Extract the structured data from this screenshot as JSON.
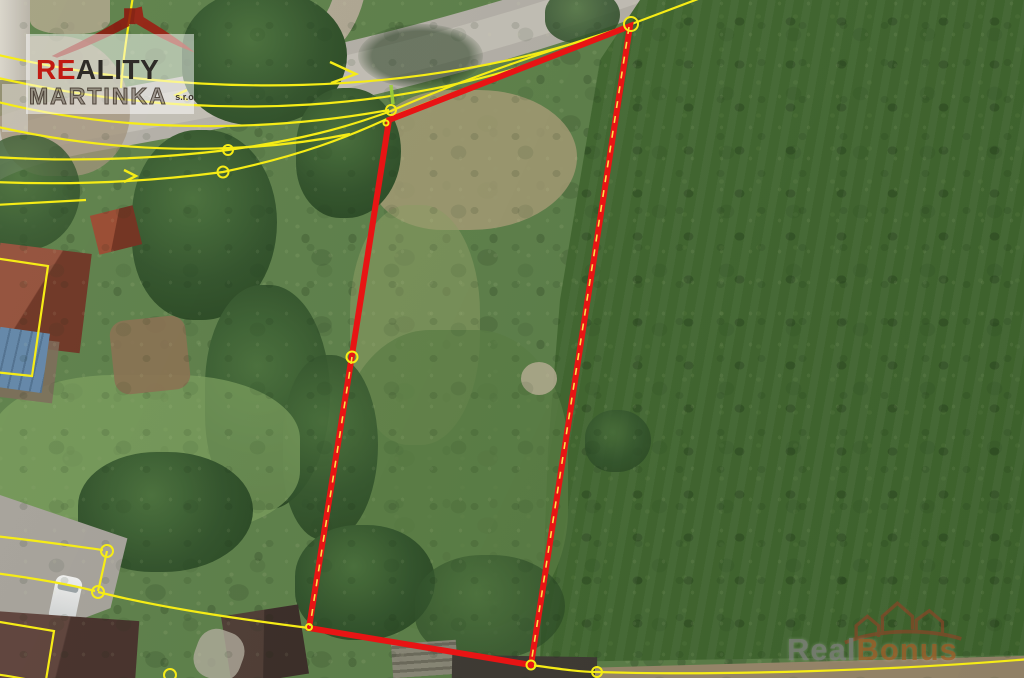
{
  "branding": {
    "agency_logo": {
      "icon": "roof-swoosh-icon",
      "word_accent": "RE",
      "word_rest": "ALITY",
      "word_secondary": "MARTINKA",
      "word_suffix": "s.r.o.",
      "accent_color": "#c11a12",
      "text_color": "#2e2b27"
    },
    "portal_watermark": {
      "icon": "houses-swoosh-icon",
      "word_part1": "Real",
      "word_part2": "Bonus",
      "part1_color": "#8d8d8a",
      "part2_color": "#a5612a"
    }
  },
  "map": {
    "kind": "aerial-photo-with-cadastral-overlay",
    "highlight_color": "#e81414",
    "cadastral_color": "#f6ec16",
    "parcel_points": "389,120 630,26 531,665 309,628",
    "edge_dashes": [
      "M 629,27 L 531,664",
      "M 352,357 L 310,626"
    ],
    "survey_tick": "M 391,85 L 393,104",
    "road_path": "M 655,-20 C 430,62 240,96 95,122 C 45,131 5,142 -20,158",
    "road_spur": "M 350,-8 C 345,15 335,30 322,42",
    "lines": [
      "M -6,54 C 180,98 420,102 629,25 L 706,-4",
      "M -6,77 C 200,124 420,120 628,27",
      "M -6,101 C 140,138 290,128 389,110",
      "M -6,126 C 150,162 280,148 350,134",
      "M -6,157 C 90,163 170,157 228,150 C 300,140 345,128 391,111 C 470,76 560,47 628,26",
      "M -6,182 C 90,186 170,179 223,172 C 300,156 348,137 389,118 C 470,85 565,53 629,28",
      "M 133,-4 C 128,28 123,58 121,88",
      "M -6,536 C 40,541 80,547 103,550",
      "M 107,551 C 104,565 101,579 98,591",
      "M -6,573 C 40,579 75,586 95,591",
      "M 98,592 C 170,610 262,622 309,628",
      "M 531,665 C 560,669 580,672 597,672 C 720,676 900,670 1030,659",
      "M -6,621 L 54,631 L 46,680",
      "M -6,674 C 10,676 20,678 30,680",
      "M -6,205 L 86,200",
      "M -6,258 L 48,266 L 32,376 L -6,372"
    ],
    "arrows": [
      "M 188,100 L 176,95 L 187,90",
      "M 330,62 L 356,74 L 331,83",
      "M 124,170 L 136,176 L 124,182"
    ],
    "vertices": [
      {
        "cx": 631,
        "cy": 24,
        "r": 7
      },
      {
        "cx": 391,
        "cy": 110,
        "r": 5
      },
      {
        "cx": 386,
        "cy": 123,
        "r": 2.5
      },
      {
        "cx": 352,
        "cy": 357,
        "r": 5.5
      },
      {
        "cx": 309,
        "cy": 627,
        "r": 3
      },
      {
        "cx": 531,
        "cy": 665,
        "r": 4.5
      },
      {
        "cx": 597,
        "cy": 672,
        "r": 5
      },
      {
        "cx": 228,
        "cy": 150,
        "r": 5
      },
      {
        "cx": 223,
        "cy": 172,
        "r": 5.5
      },
      {
        "cx": 107,
        "cy": 551,
        "r": 6
      },
      {
        "cx": 98,
        "cy": 592,
        "r": 6
      },
      {
        "cx": 170,
        "cy": 675,
        "r": 6
      }
    ]
  }
}
